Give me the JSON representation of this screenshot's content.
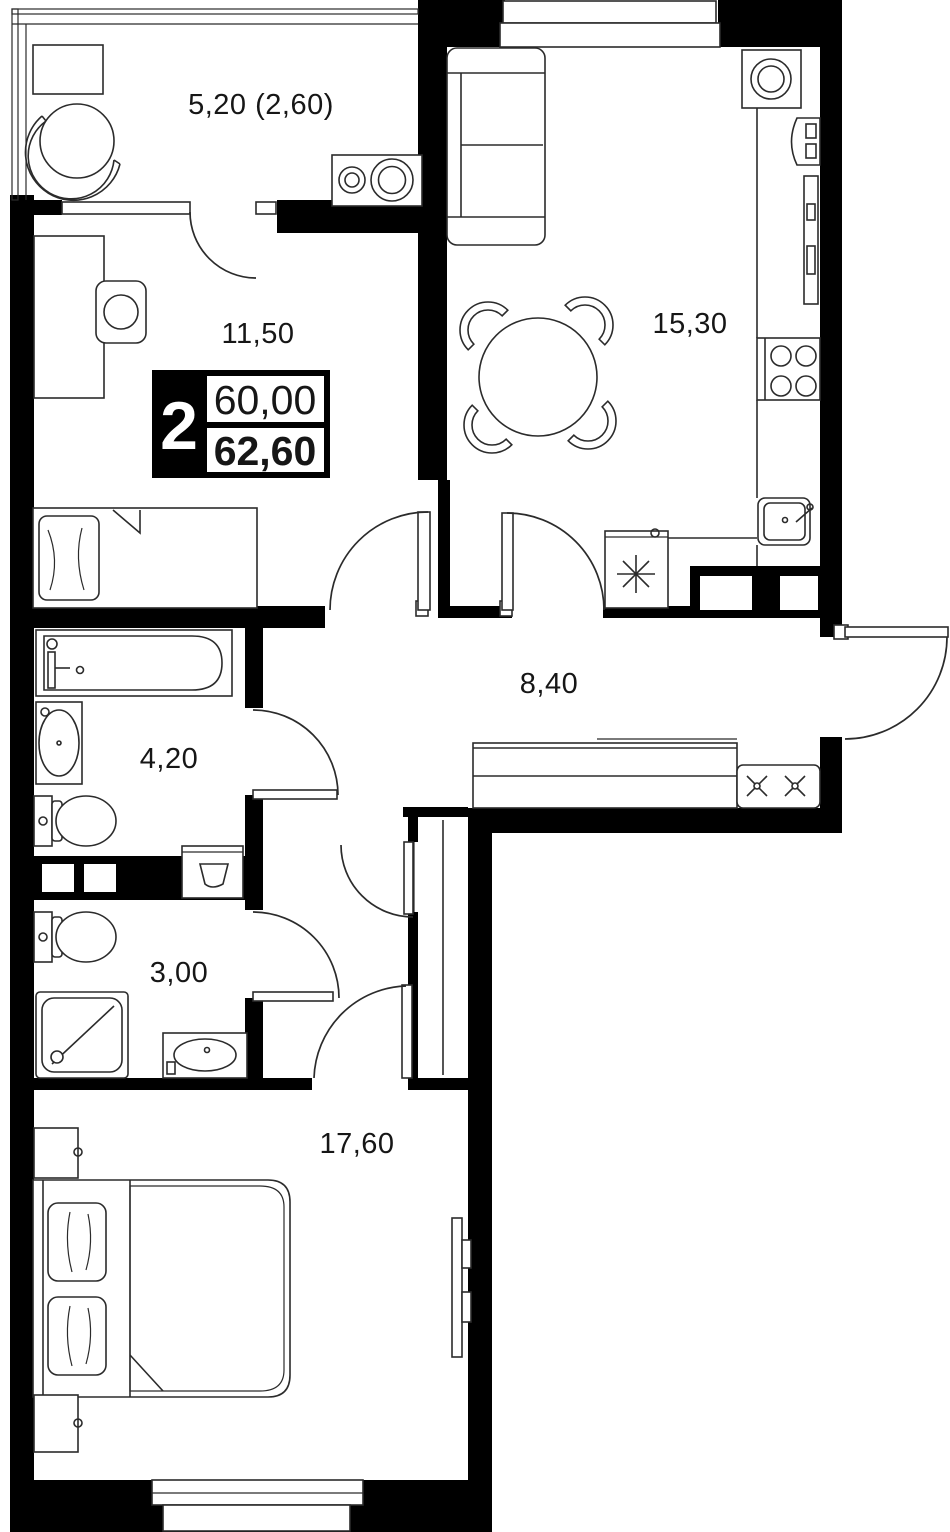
{
  "colors": {
    "walls": "#000000",
    "lines": "#2b2b2b",
    "background": "#ffffff",
    "text": "#161616"
  },
  "badge": {
    "room_count": "2",
    "area_living": "60,00",
    "area_total": "62,60"
  },
  "rooms": {
    "balcony": {
      "label": "5,20 (2,60)"
    },
    "room_small": {
      "label": "11,50"
    },
    "kitchen_living": {
      "label": "15,30"
    },
    "hallway": {
      "label": "8,40"
    },
    "bathroom": {
      "label": "4,20"
    },
    "shower_room": {
      "label": "3,00"
    },
    "bedroom": {
      "label": "17,60"
    }
  }
}
